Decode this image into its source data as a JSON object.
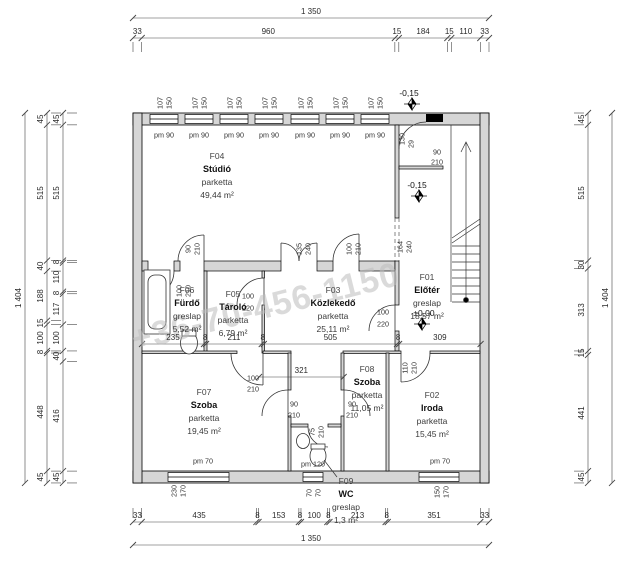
{
  "watermark": "+36-70-456-1150",
  "plan": {
    "rooms": [
      {
        "id": "F04",
        "name": "Stúdió",
        "floor": "parketta",
        "area": "49,44 m²"
      },
      {
        "id": "F06",
        "name": "Fürdő",
        "floor": "greslap",
        "area": "5,52 m²"
      },
      {
        "id": "F05",
        "name": "Tároló",
        "floor": "parketta",
        "area": "6,79 m²"
      },
      {
        "id": "F03",
        "name": "Közlekedő",
        "floor": "parketta",
        "area": "25,11 m²"
      },
      {
        "id": "F01",
        "name": "Előtér",
        "floor": "greslap",
        "area": "18,57 m²"
      },
      {
        "id": "F07",
        "name": "Szoba",
        "floor": "parketta",
        "area": "19,45 m²"
      },
      {
        "id": "F08",
        "name": "Szoba",
        "floor": "parketta",
        "area": "11,05 m²"
      },
      {
        "id": "F02",
        "name": "Iroda",
        "floor": "parketta",
        "area": "15,45 m²"
      },
      {
        "id": "F09",
        "name": "WC",
        "floor": "greslap",
        "area": "1,3 m²"
      }
    ],
    "levels": {
      "upper": "-0,15",
      "mid": "-0,15",
      "ground": "±0,00"
    }
  },
  "dimensions": {
    "top_total": "1 350",
    "top_chain": [
      "33",
      "960",
      "15",
      "184",
      "15",
      "110",
      "33"
    ],
    "bottom_chain": [
      "33",
      "435",
      "8",
      "153",
      "8",
      "100",
      "8",
      "213",
      "8",
      "351",
      "33"
    ],
    "bottom_total": "1 350",
    "left_total": "1 404",
    "left_chain_outer": [
      "45",
      "515",
      "40",
      "188",
      "15",
      "100",
      "8",
      "448",
      "45"
    ],
    "left_chain_inner": [
      "45",
      "515",
      "8",
      "110",
      "8",
      "117",
      "100",
      "40",
      "416",
      "45"
    ],
    "right_chain": [
      "45",
      "515",
      "30",
      "313",
      "15",
      "441",
      "45"
    ],
    "right_total": "1 404",
    "mid_chain": [
      "235",
      "8",
      "211",
      "8",
      "505",
      "8",
      "309"
    ],
    "f08_chain": [
      "321"
    ]
  },
  "openings": {
    "studio_window": {
      "w": "107",
      "h": "150",
      "sill": "pm 90"
    },
    "room7_window": {
      "w": "230",
      "h": "170",
      "sill": "pm 70"
    },
    "wc_window": {
      "w": "70",
      "h": "70",
      "sill": "pm 120"
    },
    "office_window": {
      "w": "150",
      "h": "170",
      "sill": "pm 70"
    },
    "door_studio": {
      "w": "90",
      "h": "210"
    },
    "door_bath": {
      "w": "100",
      "h": "210"
    },
    "door_storage": {
      "w": "100",
      "h": "220"
    },
    "door_double": {
      "w": "135",
      "h": "240"
    },
    "door_hall": {
      "w": "100",
      "h": "210"
    },
    "opening_hall": {
      "w": "164",
      "h": "240"
    },
    "door_entry": {
      "w": "100",
      "h": "220"
    },
    "door_office": {
      "w": "110",
      "h": "210"
    },
    "door_room7": {
      "w": "100",
      "h": "210"
    },
    "door_room7b": {
      "w": "90",
      "h": "210"
    },
    "door_room8": {
      "w": "90",
      "h": "210"
    },
    "door_wc": {
      "w": "75",
      "h": "210"
    },
    "door_niche": {
      "w": "90",
      "h": "210"
    },
    "niche_dim1": "130",
    "niche_dim2": "29"
  }
}
